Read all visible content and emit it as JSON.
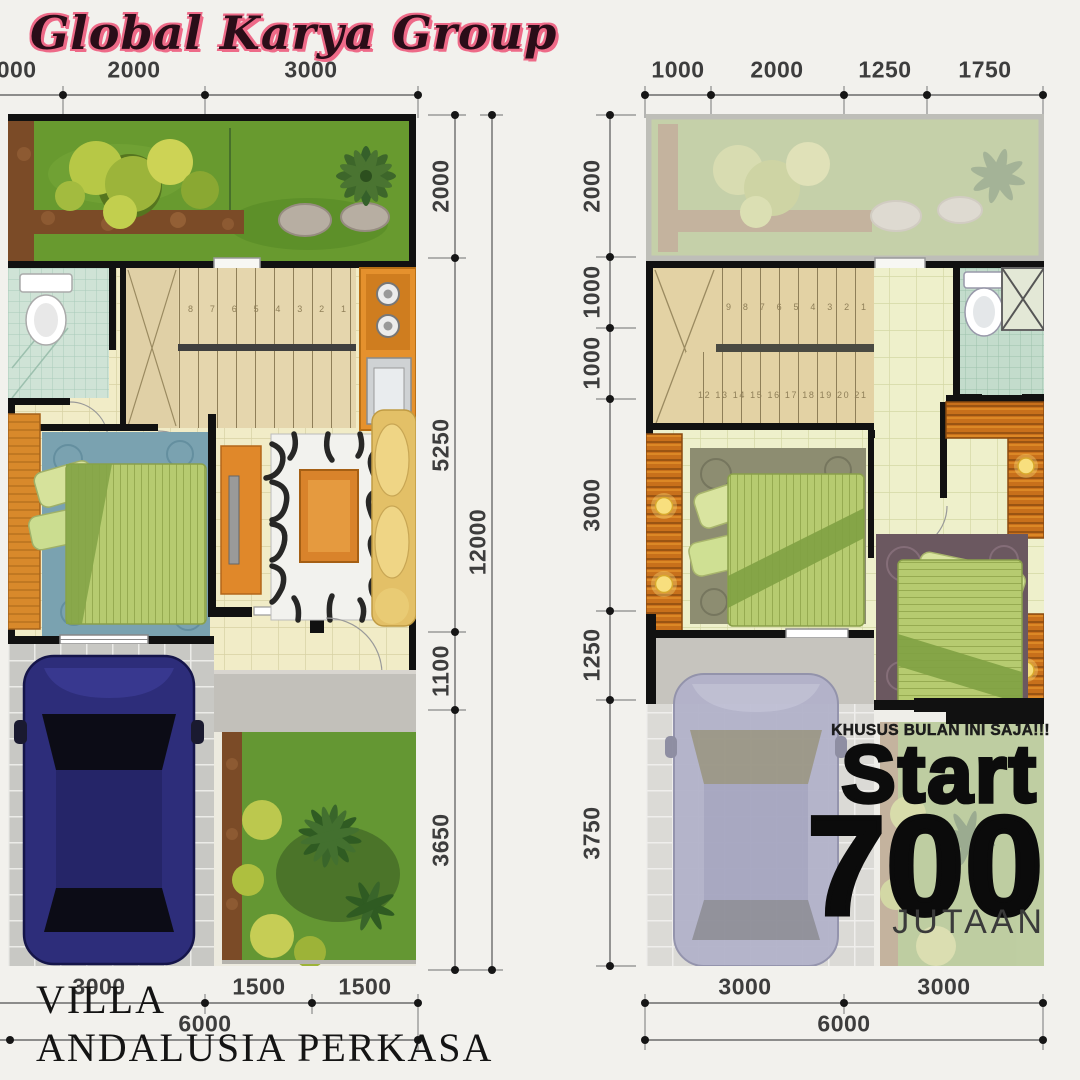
{
  "brand": {
    "name": "Global Karya Group"
  },
  "project": {
    "line1": "VILLA",
    "line2": "ANDALUSIA PERKASA"
  },
  "promo": {
    "headline": "KHUSUS BULAN INI SAJA!!!",
    "start_label": "Start",
    "price": "700",
    "unit": "JUTAAN"
  },
  "ground_floor": {
    "top_dims": [
      "1000",
      "2000",
      "3000"
    ],
    "side_dims": [
      "2000",
      "5250",
      "1100",
      "3650"
    ],
    "side_total": "12000",
    "bottom_dims": [
      "3000",
      "1500",
      "1500"
    ],
    "bottom_total": "6000",
    "stair_numbers": "8  7  6  5  4  3  2  1"
  },
  "upper_floor": {
    "top_dims": [
      "1000",
      "2000",
      "1250",
      "1750"
    ],
    "side_dims": [
      "2000",
      "1000",
      "1000",
      "3000",
      "1250",
      "3750"
    ],
    "bottom_dims": [
      "3000",
      "3000"
    ],
    "bottom_total": "6000",
    "stair_numbers_upper": "9  8  7  6  5  4  3  2  1",
    "stair_numbers_lower": "12 13 14 15 16 17 18 19 20 21"
  },
  "colors": {
    "background": "#f2f1ed",
    "wall_black": "#111111",
    "garden_green": "#689a2f",
    "mulch_brown": "#7b4b27",
    "tile_cream": "#f1ecc7",
    "tile_teal": "#cfe3d6",
    "kitchen_orange": "#e5912d",
    "wood_orange": "#d8892b",
    "rug_blue": "#7aa2b0",
    "rug_olive": "#8d8d71",
    "rug_plum": "#6b5860",
    "bed_green": "#b6cb70",
    "sofa_gold": "#e3c067",
    "car_navy": "#2d2d7a",
    "car_silver": "#b2b2ca",
    "brand_pink": "#ee6a88",
    "dim_text": "#3d3d3d",
    "promo_black": "#0b0b0b"
  }
}
